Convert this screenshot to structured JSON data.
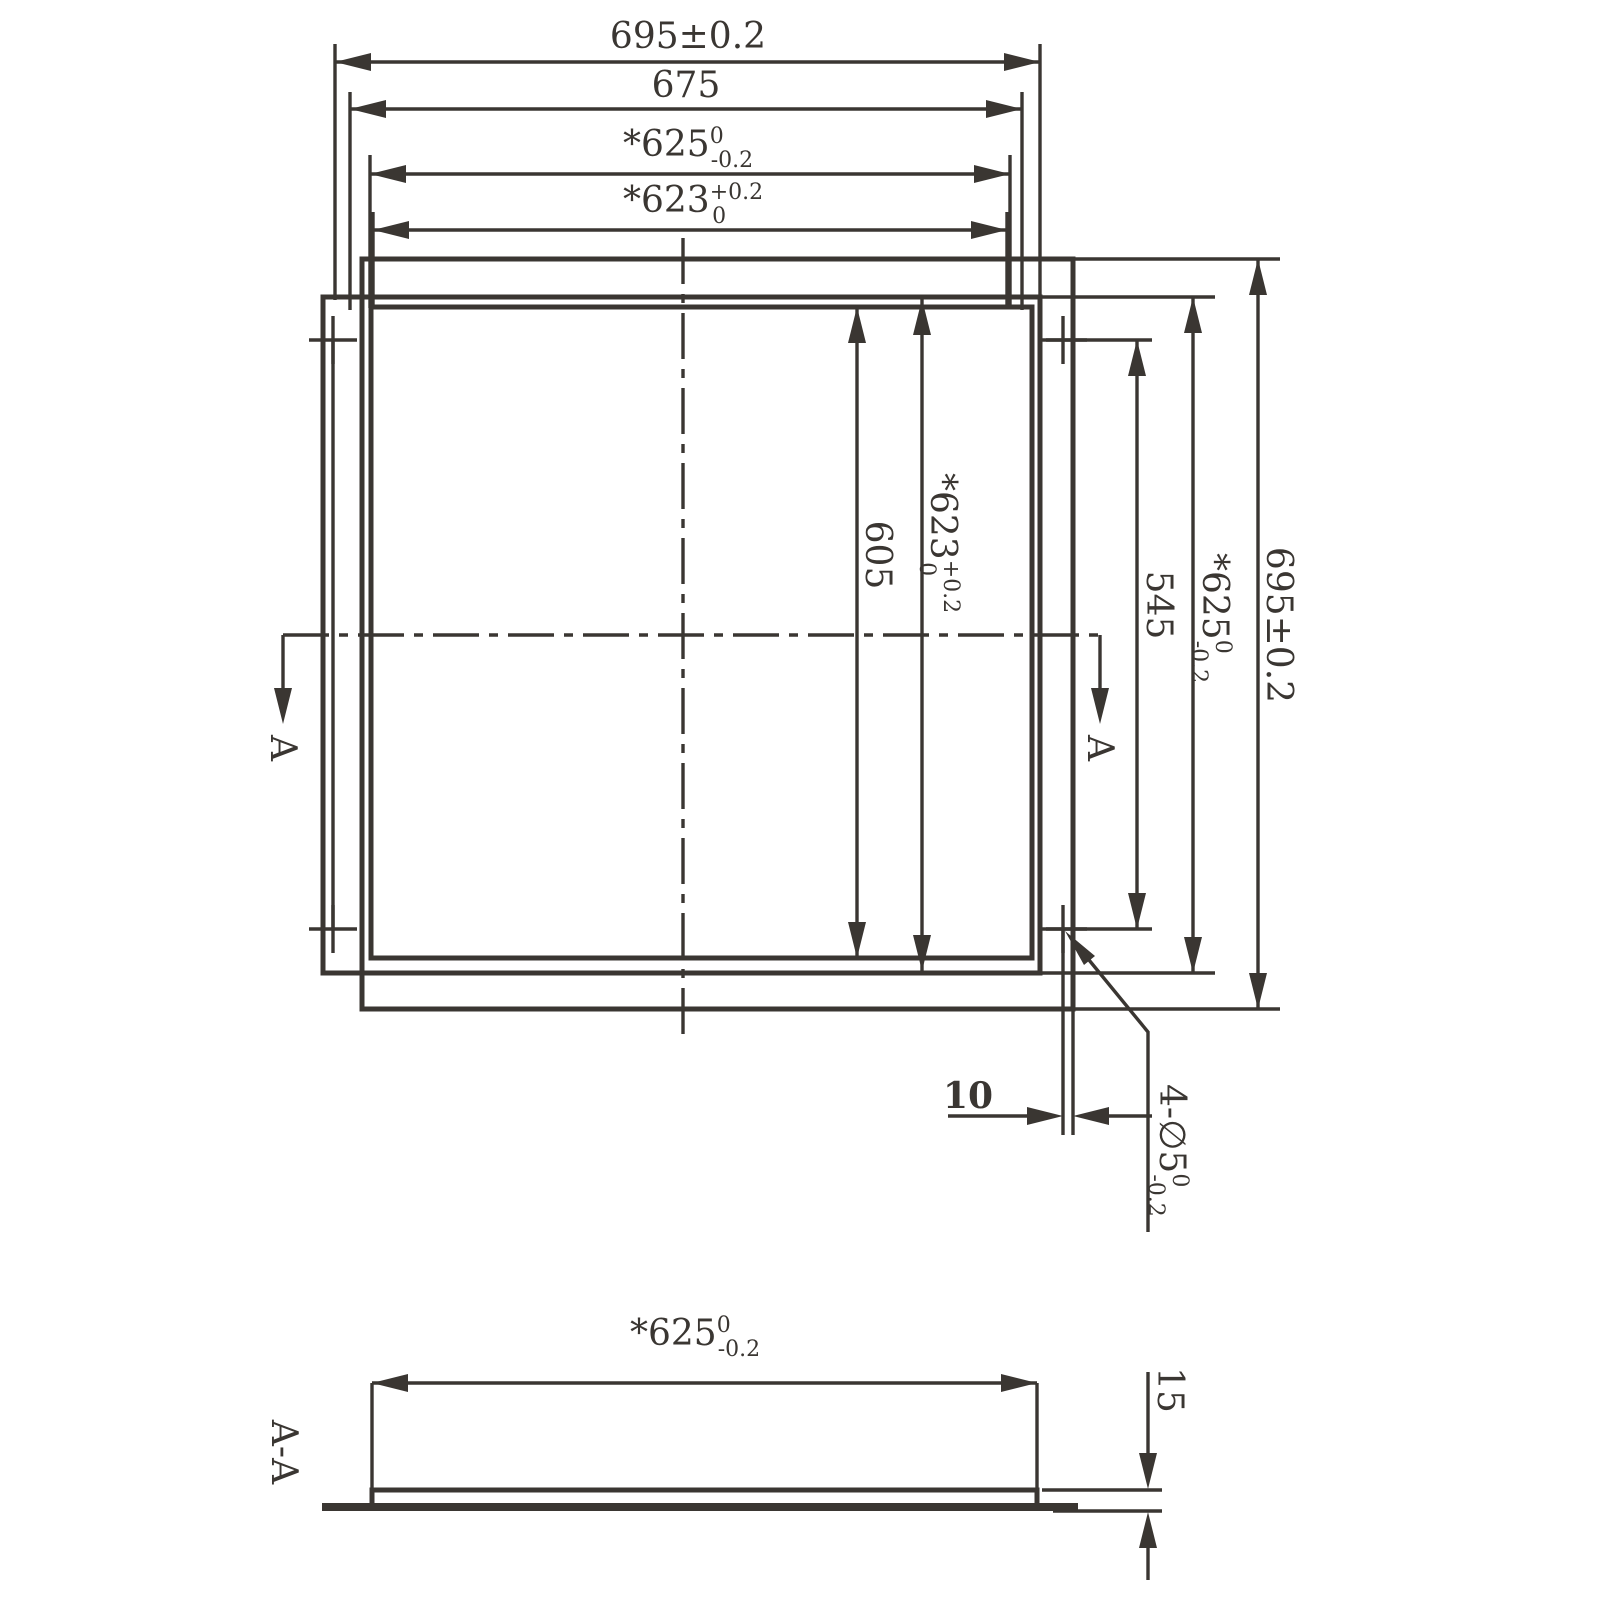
{
  "drawing": {
    "title_hint": "square panel dimension drawing",
    "line_color": "#3a3632",
    "background_color": "#ffffff",
    "plan": {
      "dims_top": [
        {
          "main": "695±0.2",
          "sup": "",
          "sub": ""
        },
        {
          "main": "675",
          "sup": "",
          "sub": ""
        },
        {
          "main": "*625",
          "sup": "0",
          "sub": "-0.2"
        },
        {
          "main": "*623",
          "sup": "+0.2",
          "sub": "0"
        }
      ],
      "dims_right": [
        {
          "main": "605",
          "sup": "",
          "sub": ""
        },
        {
          "main": "*623",
          "sup": "+0.2",
          "sub": "0"
        },
        {
          "main": "545",
          "sup": "",
          "sub": ""
        },
        {
          "main": "*625",
          "sup": "0",
          "sub": "-0.2"
        },
        {
          "main": "695±0.2",
          "sup": "",
          "sub": ""
        }
      ],
      "dim_hole_offset": "10",
      "holes_label": {
        "main": "4-∅5",
        "sup": "0",
        "sub": "-0.2"
      },
      "section_marker": "A"
    },
    "section": {
      "label": "A-A",
      "dim_width": {
        "main": "*625",
        "sup": "0",
        "sub": "-0.2"
      },
      "dim_height": "15"
    }
  }
}
